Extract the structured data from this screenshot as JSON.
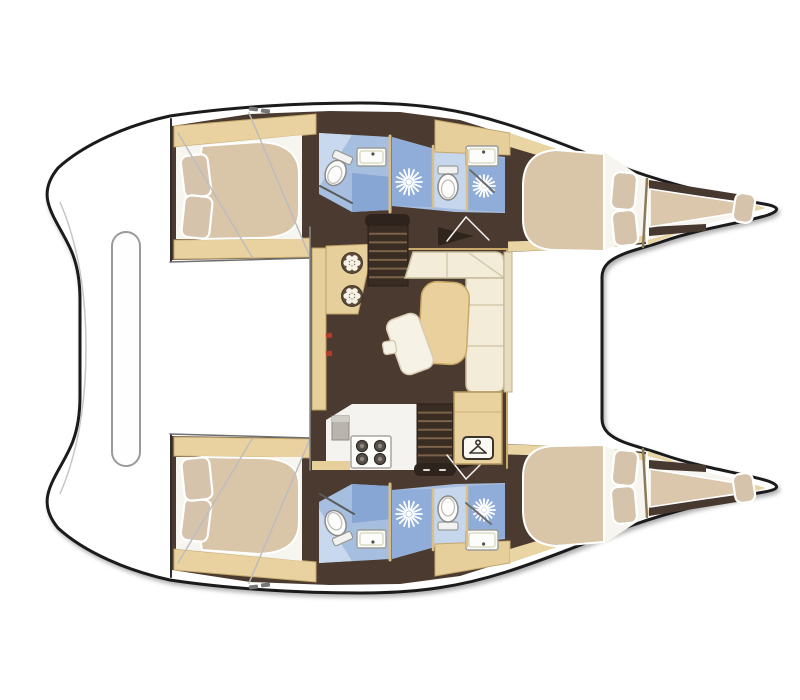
{
  "meta": {
    "description": "Top-view interior layout plan of a 4-cabin sailing catamaran, bows to the right",
    "canvas": {
      "w": 800,
      "h": 700
    }
  },
  "palette": {
    "hull_outline": "#1b1b1b",
    "deck_white": "#ffffff",
    "floor_brown": "#4b3a30",
    "stair_brown": "#392c23",
    "wood_beige": "#e7cf9c",
    "lining_beige": "#e9d5a3",
    "mattress_tan": "#d9c5a8",
    "sofa_cream": "#f2ecd9",
    "bath_blue": "#a6bedf",
    "bath_blue_light": "#c6d6ec",
    "bath_blue_deep": "#87a6d3",
    "fixture_white": "#fcfcfb",
    "accent_red": "#b23c2b"
  },
  "silhouette": {
    "name": "boat-hull-silhouette",
    "d": "M 170,116 C 230,107 300,103 360,103 C 420,103 462,110 506,124 C 548,137 586,154 630,170 C 672,185 722,197 764,204 Q 787,208 768,215 C 742,223 702,228 664,241 C 642,249 620,252 608,263 Q 602,269 602,277 L 602,419 Q 602,427 608,433 C 620,444 642,447 664,455 C 702,468 742,473 768,481 Q 787,488 764,492 C 722,499 672,511 630,526 C 586,542 548,559 506,572 C 462,586 420,593 360,593 C 300,593 230,589 170,580 C 128,571 84,552 58,528 Q 44,511 48,494 C 52,477 66,460 73,441 Q 80,422 80,396 L 80,300 Q 80,274 73,255 C 66,236 52,219 48,202 Q 44,185 58,168 C 84,144 128,125 170,116 Z",
    "fill": "#ffffff",
    "stroke": "#1b1b1b",
    "sw": 3
  },
  "hull_shapes": [
    {
      "name": "hull-floor",
      "type": "poly",
      "points": "172,126 250,114 330,111 400,112 460,120 520,139 575,158 625,176 646,183 646,244 620,246 560,250 505,252 400,256 310,258 172,260",
      "fill": "#4b3a30"
    },
    {
      "name": "aft-cabin-trim-top",
      "type": "poly",
      "points": "174,126 316,114 316,134 174,147",
      "fill": "#e9d2a0",
      "stroke": "#c4a86e",
      "sw": 1
    },
    {
      "name": "aft-cabin-trim-bottom",
      "type": "poly",
      "points": "174,240 316,238 316,257 174,259",
      "fill": "#e9d2a0",
      "stroke": "#c4a86e",
      "sw": 1
    },
    {
      "name": "aft-cabin-bed-base",
      "type": "poly",
      "points": "176,147 302,135 302,239 176,239",
      "fill": "#f7f5ef"
    },
    {
      "name": "aft-cabin-mattress",
      "type": "path",
      "d": "M 202,146 L 258,142 Q 299,143 299,174 L 299,212 Q 299,238 258,238 L 202,239 Q 194,192 202,146 Z",
      "fill": "#d9c5a8",
      "stroke": "#ffffff",
      "sw": 2
    },
    {
      "name": "aft-cabin-pillow-1",
      "type": "pillow",
      "cx": 196,
      "cy": 176,
      "w": 27,
      "h": 42,
      "rot": -7
    },
    {
      "name": "aft-cabin-pillow-2",
      "type": "pillow",
      "cx": 197,
      "cy": 217,
      "w": 28,
      "h": 42,
      "rot": 6
    },
    {
      "name": "aft-cabin-bulkhead",
      "type": "line",
      "x1": 171,
      "y1": 119,
      "x2": 171,
      "y2": 261,
      "stroke": "#2e2e2e",
      "sw": 2
    },
    {
      "name": "aft-head-floor",
      "type": "poly",
      "points": "319,133 390,137 390,210 352,212 319,194",
      "fill": "#a6bedf"
    },
    {
      "name": "aft-head-shower-panel",
      "type": "poly",
      "points": "319,133 352,135 319,187",
      "fill": "#c8d8ee"
    },
    {
      "name": "aft-head-floor-deep",
      "type": "poly",
      "points": "352,173 390,177 390,210 352,212",
      "fill": "#87a6d3"
    },
    {
      "name": "aft-head-sink",
      "type": "sink",
      "x": 357,
      "y": 148,
      "w": 29,
      "h": 18
    },
    {
      "name": "aft-head-toilet",
      "type": "toilet",
      "cx": 336,
      "cy": 172,
      "rot": 24
    },
    {
      "name": "head-divider-wall",
      "type": "line",
      "x1": 390,
      "y1": 136,
      "x2": 390,
      "y2": 212,
      "stroke": "#d9bf8a",
      "sw": 3
    },
    {
      "name": "fwd-head-floor",
      "type": "poly",
      "points": "392,137 435,149 505,157 505,213 455,212 392,206",
      "fill": "#a6bedf"
    },
    {
      "name": "fwd-head-shower-stall-aft",
      "type": "poly",
      "points": "392,137 433,149 433,207 392,206",
      "fill": "#8fadd8"
    },
    {
      "name": "fwd-head-floor-light",
      "type": "poly",
      "points": "433,149 467,153 467,210 433,207",
      "fill": "#c6d6ec"
    },
    {
      "name": "fwd-head-shower-stall-fwd",
      "type": "poly",
      "points": "467,153 505,158 505,212 467,210",
      "fill": "#8fadd8"
    },
    {
      "name": "fwd-head-counter",
      "type": "poly",
      "points": "435,120 510,133 510,155 435,152",
      "fill": "#e7cf9c",
      "stroke": "#c4a86e",
      "sw": 1
    },
    {
      "name": "fwd-head-sink",
      "type": "sink",
      "x": 466,
      "y": 146,
      "w": 32,
      "h": 20
    },
    {
      "name": "fwd-head-stall-wall-1",
      "type": "line",
      "x1": 433,
      "y1": 146,
      "x2": 433,
      "y2": 207,
      "stroke": "#d9bf8a",
      "sw": 2.5
    },
    {
      "name": "fwd-head-stall-wall-2",
      "type": "line",
      "x1": 467,
      "y1": 150,
      "x2": 467,
      "y2": 210,
      "stroke": "#d9bf8a",
      "sw": 2.5
    },
    {
      "name": "fwd-head-shower-rose-aft",
      "type": "sunburst",
      "cx": 409,
      "cy": 182,
      "r": 13
    },
    {
      "name": "fwd-head-toilet",
      "type": "toilet",
      "cx": 448,
      "cy": 186,
      "rot": 0
    },
    {
      "name": "fwd-head-shower-rose-fwd",
      "type": "sunburst",
      "cx": 484,
      "cy": 186,
      "r": 11
    },
    {
      "name": "fwd-cabin-lining-top",
      "type": "poly",
      "points": "510,133 560,150 620,170 646,179 646,191 620,182 560,162 510,147",
      "fill": "#e9d5a3"
    },
    {
      "name": "fwd-cabin-lining-bottom",
      "type": "poly",
      "points": "490,242 560,240 620,236 646,232 646,242 620,246 560,250 490,252",
      "fill": "#e9d5a3"
    },
    {
      "name": "fwd-cabin-bed-base",
      "type": "poly",
      "points": "604,152 646,180 646,234 604,250",
      "fill": "#f7f5ef"
    },
    {
      "name": "fwd-cabin-mattress",
      "type": "path",
      "d": "M 604,154 L 556,150 Q 523,152 523,186 L 523,219 Q 523,250 556,250 L 604,251 Z",
      "fill": "#d9c5a8",
      "stroke": "#ffffff",
      "sw": 2
    },
    {
      "name": "fwd-cabin-pillow-1",
      "type": "pillow",
      "cx": 624,
      "cy": 191,
      "w": 24,
      "h": 37,
      "rot": 5
    },
    {
      "name": "fwd-cabin-pillow-2",
      "type": "pillow",
      "cx": 625,
      "cy": 228,
      "w": 24,
      "h": 35,
      "rot": -6
    },
    {
      "name": "forepeak-bulkhead",
      "type": "line",
      "x1": 647,
      "y1": 179,
      "x2": 643,
      "y2": 247,
      "stroke": "#8b7a5a",
      "sw": 2.5
    },
    {
      "name": "forepeak-shell",
      "type": "poly",
      "points": "648,181 710,195 752,204 766,208 752,212 710,221 648,245",
      "fill": "#e9d5a3"
    },
    {
      "name": "forepeak-berth-base",
      "type": "poly",
      "points": "648,186 744,202 744,214 648,240",
      "fill": "#f7f5ef"
    },
    {
      "name": "forepeak-board-aft",
      "type": "poly",
      "points": "649,180 737,194 737,201 649,189",
      "fill": "#473830"
    },
    {
      "name": "forepeak-board-fwd",
      "type": "poly",
      "points": "649,227 706,224 706,231 649,236",
      "fill": "#473830"
    },
    {
      "name": "forepeak-mattress",
      "type": "poly",
      "points": "650,189 736,202 736,213 650,227",
      "fill": "#dbc7ab",
      "stroke": "#ffffff",
      "sw": 1.5
    },
    {
      "name": "forepeak-pillow",
      "type": "pillow",
      "cx": 744,
      "cy": 208,
      "w": 20,
      "h": 29,
      "rot": 9
    },
    {
      "name": "transom-seam-1",
      "type": "line",
      "x1": 178,
      "y1": 133,
      "x2": 252,
      "y2": 257,
      "stroke": "#bdbdbd",
      "sw": 1.5
    },
    {
      "name": "transom-seam-2",
      "type": "line",
      "x1": 249,
      "y1": 113,
      "x2": 310,
      "y2": 257,
      "stroke": "#bdbdbd",
      "sw": 1.5
    },
    {
      "name": "hull-inner-edge-aft",
      "type": "line",
      "x1": 170,
      "y1": 262,
      "x2": 312,
      "y2": 258,
      "stroke": "#6f6f6f",
      "sw": 1.5
    },
    {
      "name": "deck-cleat-1",
      "type": "rect",
      "x": 249,
      "y": 107,
      "w": 9,
      "h": 4,
      "rx": 1,
      "fill": "#777777",
      "rot": 6
    },
    {
      "name": "deck-cleat-2",
      "type": "rect",
      "x": 261,
      "y": 109,
      "w": 9,
      "h": 4,
      "rx": 1,
      "fill": "#777777",
      "rot": 6
    }
  ],
  "center_shapes": [
    {
      "name": "cockpit-table",
      "type": "rect",
      "x": 112,
      "y": 232,
      "w": 28,
      "h": 234,
      "rx": 14,
      "fill": "#fefefe",
      "stroke": "#9a9a9a",
      "sw": 2
    },
    {
      "name": "deck-contour",
      "type": "path",
      "d": "M 60,202 Q 86,262 86,348 Q 86,434 60,494",
      "fill": "none",
      "stroke": "#c6c6c6",
      "sw": 1.5
    },
    {
      "name": "salon-floor",
      "type": "rect",
      "x": 310,
      "y": 227,
      "w": 198,
      "h": 243,
      "fill": "#4b3a30"
    },
    {
      "name": "salon-aft-wall",
      "type": "line",
      "x1": 310,
      "y1": 227,
      "x2": 310,
      "y2": 470,
      "stroke": "#8a8a8a",
      "sw": 1.5
    },
    {
      "name": "salon-port-wall",
      "type": "line",
      "x1": 408,
      "y1": 249,
      "x2": 506,
      "y2": 249,
      "stroke": "#caa96a",
      "sw": 2
    },
    {
      "name": "salon-fwd-wall",
      "type": "line",
      "x1": 507,
      "y1": 249,
      "x2": 507,
      "y2": 468,
      "stroke": "#caa96a",
      "sw": 2
    },
    {
      "name": "galley-side-counter",
      "type": "rect",
      "x": 312,
      "y": 248,
      "w": 14,
      "h": 162,
      "fill": "#e7cf9c",
      "stroke": "#b99c62",
      "sw": 1
    },
    {
      "name": "galley-aft-counter",
      "type": "poly",
      "points": "326,246 374,244 366,278 358,314 326,314",
      "fill": "#e7cf9c",
      "stroke": "#b99c62",
      "sw": 1
    },
    {
      "name": "galley-sink-1",
      "type": "rosette",
      "cx": 352,
      "cy": 263
    },
    {
      "name": "galley-sink-2",
      "type": "rosette",
      "cx": 352,
      "cy": 296
    },
    {
      "name": "galley-accent-1",
      "type": "rect",
      "x": 326,
      "y": 333,
      "w": 6,
      "h": 5,
      "fill": "#b23c2b",
      "rot": -8
    },
    {
      "name": "galley-accent-2",
      "type": "rect",
      "x": 326,
      "y": 351,
      "w": 6,
      "h": 5,
      "fill": "#b23c2b",
      "rot": -8
    },
    {
      "name": "port-companionway-landing",
      "type": "rect",
      "x": 365,
      "y": 214,
      "w": 45,
      "h": 13,
      "rx": 6,
      "fill": "#2e241d"
    },
    {
      "name": "port-companionway-stairs",
      "type": "stairs",
      "x": 368,
      "y": 225,
      "w": 40,
      "h": 61,
      "steps": 6
    },
    {
      "name": "port-cabin-door",
      "type": "poly",
      "points": "438,227 474,236 438,246",
      "fill": "#30251d"
    },
    {
      "name": "port-door-swing-1",
      "type": "line",
      "x1": 447,
      "y1": 241,
      "x2": 466,
      "y2": 217,
      "stroke": "#f4f4f2",
      "sw": 1.5
    },
    {
      "name": "port-door-swing-2",
      "type": "line",
      "x1": 466,
      "y1": 217,
      "x2": 489,
      "y2": 240,
      "stroke": "#f4f4f2",
      "sw": 1.5
    },
    {
      "name": "sofa-seat-aft",
      "type": "path",
      "d": "M 413,252 L 495,252 Q 504,252 504,262 L 504,278 L 405,278 Z",
      "fill": "#f2ecd9",
      "stroke": "#c9bc9b",
      "sw": 1.5
    },
    {
      "name": "sofa-seam-1",
      "type": "line",
      "x1": 447,
      "y1": 253,
      "x2": 447,
      "y2": 277,
      "stroke": "#d6caad",
      "sw": 1.5
    },
    {
      "name": "sofa-seam-2",
      "type": "line",
      "x1": 469,
      "y1": 253,
      "x2": 503,
      "y2": 277,
      "stroke": "#d6caad",
      "sw": 1.5
    },
    {
      "name": "sofa-seat-fwd",
      "type": "path",
      "d": "M 466,278 L 504,278 L 504,384 Q 504,392 495,392 L 474,392 Q 466,392 466,384 Z",
      "fill": "#f2ecd9",
      "stroke": "#c9bc9b",
      "sw": 1.5
    },
    {
      "name": "sofa-seam-3",
      "type": "line",
      "x1": 467,
      "y1": 305,
      "x2": 503,
      "y2": 305,
      "stroke": "#d6caad",
      "sw": 1.5
    },
    {
      "name": "sofa-seam-4",
      "type": "line",
      "x1": 467,
      "y1": 346,
      "x2": 503,
      "y2": 346,
      "stroke": "#d6caad",
      "sw": 1.5
    },
    {
      "name": "sofa-backrest",
      "type": "rect",
      "x": 504,
      "y": 252,
      "w": 8,
      "h": 140,
      "fill": "#e8dcc0",
      "stroke": "#c0b08a",
      "sw": 1
    },
    {
      "name": "salon-table",
      "type": "rect",
      "x": 420,
      "y": 282,
      "w": 48,
      "h": 82,
      "rx": 16,
      "fill": "#e9d09c",
      "stroke": "#c9a966",
      "sw": 1.5,
      "rot": 3
    },
    {
      "name": "salon-bench",
      "type": "rect",
      "x": 393,
      "y": 315,
      "w": 34,
      "h": 58,
      "rx": 9,
      "fill": "#f6f2e6",
      "stroke": "#d8cdb4",
      "sw": 1.5,
      "rot": -20
    },
    {
      "name": "salon-side-table",
      "type": "rect",
      "x": 383,
      "y": 341,
      "w": 13,
      "h": 13,
      "rx": 3,
      "fill": "#f6f2e6",
      "stroke": "#cfc4a9",
      "sw": 1.2,
      "rot": -10
    },
    {
      "name": "galley-floor",
      "type": "poly",
      "points": "326,420 352,404 420,404 420,470 326,470",
      "fill": "#f4f3ef"
    },
    {
      "name": "galley-fridge",
      "type": "fridge",
      "x": 332,
      "y": 416,
      "w": 17,
      "h": 24
    },
    {
      "name": "galley-stove",
      "type": "rect",
      "x": 351,
      "y": 436,
      "w": 40,
      "h": 32,
      "rx": 2,
      "fill": "#fdfdfc",
      "stroke": "#a9a5a0",
      "sw": 1.5
    },
    {
      "name": "stove-burner-1",
      "type": "burner",
      "cx": 362,
      "cy": 446,
      "r": 5.5
    },
    {
      "name": "stove-burner-2",
      "type": "burner",
      "cx": 380,
      "cy": 446,
      "r": 5.5
    },
    {
      "name": "stove-burner-3",
      "type": "burner",
      "cx": 362,
      "cy": 459,
      "r": 5.5
    },
    {
      "name": "stove-burner-4",
      "type": "burner",
      "cx": 380,
      "cy": 459,
      "r": 5.5
    },
    {
      "name": "stbd-companionway-stairs",
      "type": "stairs",
      "x": 417,
      "y": 404,
      "w": 36,
      "h": 60,
      "steps": 6
    },
    {
      "name": "stbd-companionway-landing",
      "type": "rect",
      "x": 414,
      "y": 463,
      "w": 42,
      "h": 13,
      "rx": 6,
      "fill": "#2e241d"
    },
    {
      "name": "landing-handle-1",
      "type": "line",
      "x1": 424,
      "y1": 470,
      "x2": 429,
      "y2": 470,
      "stroke": "#dddddd",
      "sw": 2
    },
    {
      "name": "landing-handle-2",
      "type": "line",
      "x1": 440,
      "y1": 470,
      "x2": 445,
      "y2": 470,
      "stroke": "#dddddd",
      "sw": 2
    },
    {
      "name": "stbd-cabin-door",
      "type": "poly",
      "points": "456,452 490,461 456,470",
      "fill": "#30251d"
    },
    {
      "name": "stbd-door-swing-1",
      "type": "line",
      "x1": 447,
      "y1": 455,
      "x2": 466,
      "y2": 479,
      "stroke": "#f4f4f2",
      "sw": 1.5
    },
    {
      "name": "stbd-door-swing-2",
      "type": "line",
      "x1": 466,
      "y1": 479,
      "x2": 489,
      "y2": 456,
      "stroke": "#f4f4f2",
      "sw": 1.5
    },
    {
      "name": "wardrobe",
      "type": "rect",
      "x": 454,
      "y": 392,
      "w": 48,
      "h": 72,
      "fill": "#ead29f",
      "stroke": "#b3945c",
      "sw": 1.5
    },
    {
      "name": "wardrobe-seam",
      "type": "line",
      "x1": 455,
      "y1": 412,
      "x2": 501,
      "y2": 412,
      "stroke": "#c9ad74",
      "sw": 1
    },
    {
      "name": "wardrobe-hanger-plate",
      "type": "rect",
      "x": 463,
      "y": 437,
      "w": 30,
      "h": 22,
      "rx": 4,
      "fill": "#faf8f2",
      "stroke": "#3a342c",
      "sw": 2
    },
    {
      "name": "hanger-icon",
      "type": "hanger",
      "cx": 478,
      "cy": 449
    },
    {
      "name": "salon-bottom-trim",
      "type": "rect",
      "x": 312,
      "y": 461,
      "w": 38,
      "h": 9,
      "fill": "#e7cf9c"
    },
    {
      "name": "aft-head-glass-port",
      "type": "line",
      "x1": 320,
      "y1": 186,
      "x2": 352,
      "y2": 203,
      "stroke": "#5a5a5a",
      "sw": 2
    },
    {
      "name": "aft-head-glass-stbd",
      "type": "line",
      "x1": 320,
      "y1": 494,
      "x2": 354,
      "y2": 514,
      "stroke": "#5a5a5a",
      "sw": 2
    },
    {
      "name": "shower-wand-port",
      "type": "line",
      "x1": 470,
      "y1": 170,
      "x2": 494,
      "y2": 192,
      "stroke": "#6e6e6e",
      "sw": 2
    },
    {
      "name": "shower-wand-stbd",
      "type": "line",
      "x1": 466,
      "y1": 503,
      "x2": 491,
      "y2": 524,
      "stroke": "#6e6e6e",
      "sw": 2
    }
  ]
}
